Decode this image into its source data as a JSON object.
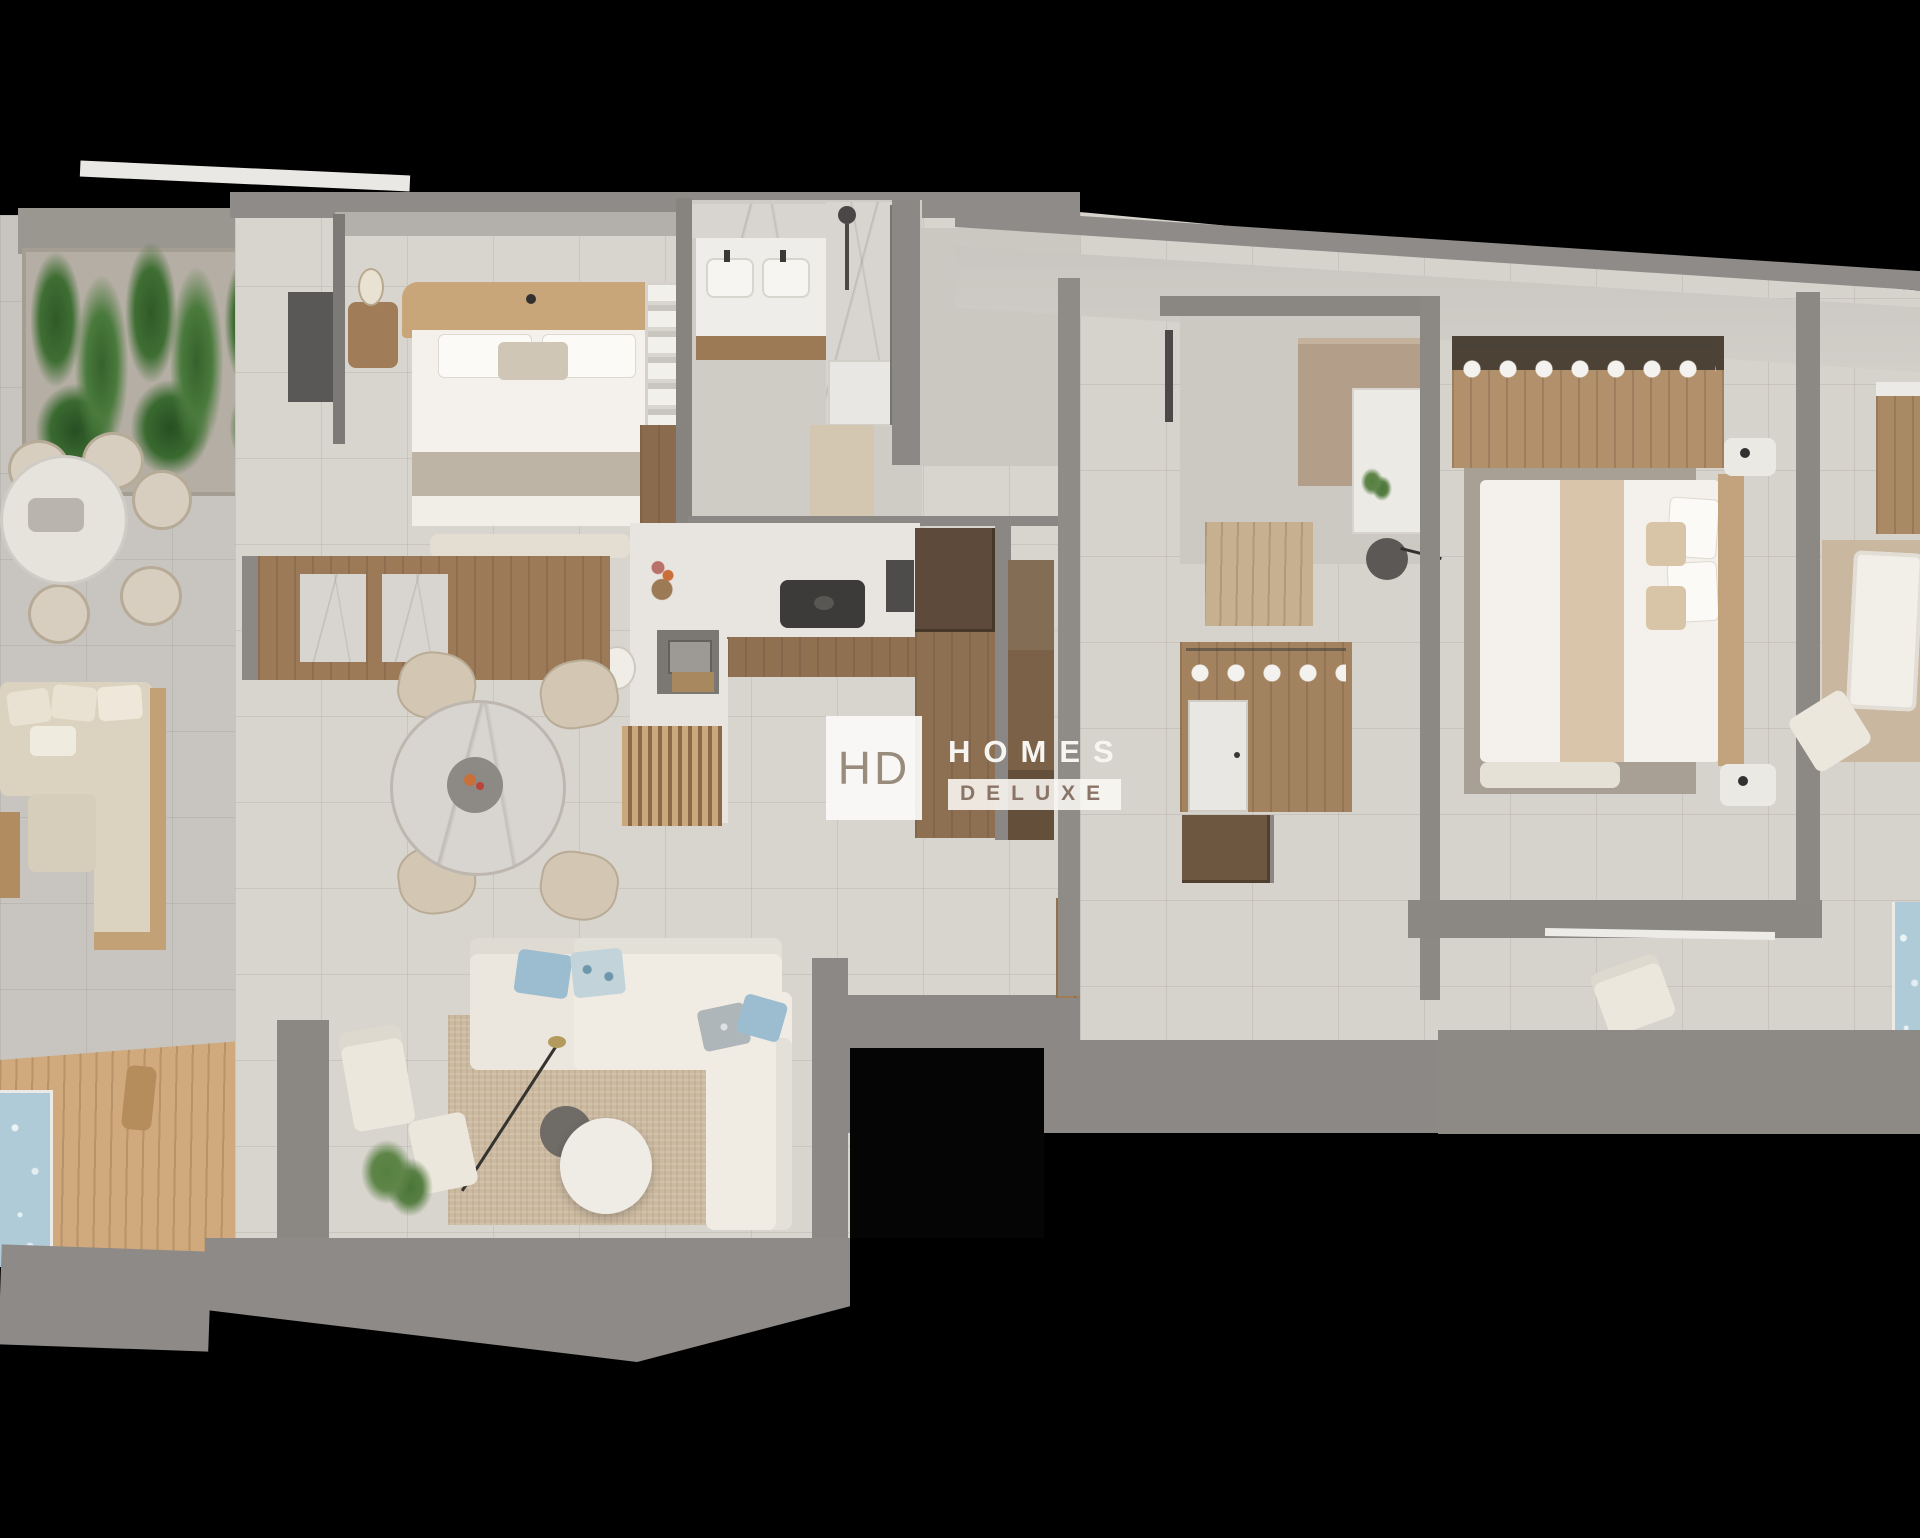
{
  "watermark": {
    "monogram": "HD",
    "line1": "HOMES",
    "line2": "DELUXE"
  },
  "palette": {
    "bg": "#000000",
    "wall": "#8c8985",
    "wall-dark": "#6f6d6a",
    "wall-light": "#c0bcb7",
    "floor-in": "#d8d4ce",
    "floor-ter": "#c8c5c0",
    "wood": "#a9855e",
    "wood-dark": "#5f4a39",
    "wood-mid": "#8c6d4f",
    "deck": "#d0a97c",
    "cream": "#ece7dc",
    "sofa": "#f0ece3",
    "beige": "#d9c6aa",
    "rug": "#cbb9a0",
    "rug-dark": "#a8a094",
    "blue": "#9cbcd0",
    "pool": "#aecbd7",
    "green": "#3f6e33",
    "green-light": "#6a8f58",
    "marble": "#d8d5d0",
    "dark": "#3c3b39",
    "logo-text": "#f7f5f1",
    "logo-brown": "#8a7467",
    "logo-mono": "#998c7d"
  }
}
